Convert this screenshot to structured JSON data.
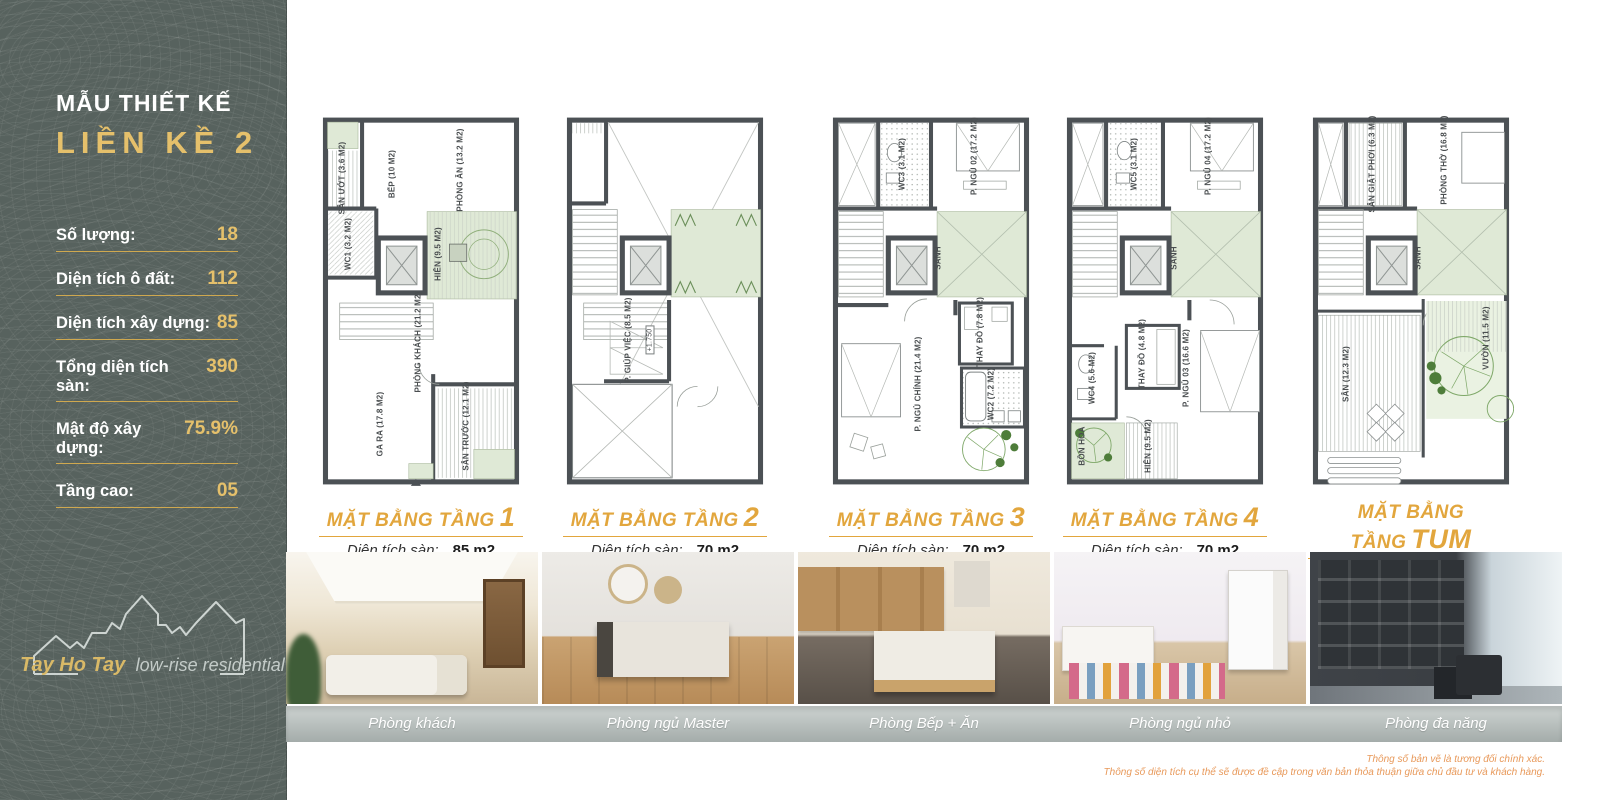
{
  "sidebar": {
    "title_line1": "MẪU THIẾT KẾ",
    "title_line2": "LIỀN KỀ 2",
    "stats": [
      {
        "label": "Số lượng:",
        "value": "18"
      },
      {
        "label": "Diện tích ô đất:",
        "value": "112"
      },
      {
        "label": "Diện tích xây dựng:",
        "value": "85"
      },
      {
        "label": "Tổng diện tích sàn:",
        "value": "390"
      },
      {
        "label": "Mật độ xây dựng:",
        "value": "75.9%"
      },
      {
        "label": "Tầng cao:",
        "value": "05"
      }
    ],
    "logo": {
      "brand": "Tay Ho Tay",
      "tagline": "low-rise residential"
    }
  },
  "plans": [
    {
      "title": "MẶT BẰNG TẦNG",
      "number": "1",
      "area_label": "Diện tích sàn:",
      "area_value": "85 m2",
      "rooms": [
        "SÂN ƯỚT (3.6 M2)",
        "BẾP (10 M2)",
        "PHÒNG ĂN (13.2 M2)",
        "WC1 (3.2 M2)",
        "HIÊN (9.5 M2)",
        "PHÒNG KHÁCH (21.2 M2)",
        "GA RA (17.8 M2)",
        "SÂN TRƯỚC (12.1 M2)"
      ]
    },
    {
      "title": "MẶT BẰNG TẦNG",
      "number": "2",
      "area_label": "Diện tích sàn:",
      "area_value": "70 m2",
      "rooms": [
        "P. GIÚP VIỆC (8.5 M2)",
        "+1.750"
      ]
    },
    {
      "title": "MẶT BẰNG TẦNG",
      "number": "3",
      "area_label": "Diện tích sàn:",
      "area_value": "70 m2",
      "rooms": [
        "WC3 (3.1 M2)",
        "P. NGỦ 02 (17.2 M2)",
        "SẢNH",
        "THAY ĐỒ (7.8 M2)",
        "P. NGỦ CHÍNH (21.4 M2)",
        "WC2 (7.2 M2)"
      ]
    },
    {
      "title": "MẶT BẰNG TẦNG",
      "number": "4",
      "area_label": "Diện tích sàn:",
      "area_value": "70 m2",
      "rooms": [
        "WC5 (3.1 M2)",
        "P. NGỦ 04 (17.2 M2)",
        "SẢNH",
        "THAY ĐỒ (4.8 M2)",
        "WC4 (5.6 M2)",
        "P. NGỦ 03 (16.6 M2)",
        "BỒN HOA",
        "HIÊN (9.5 M2)"
      ]
    },
    {
      "title": "MẶT BẰNG TẦNG",
      "number": "TUM",
      "area_label": "Diện tích sàn:",
      "area_value": "38 m2",
      "rooms": [
        "SÂN GIẶT PHƠI (6.3 M2)",
        "PHÒNG THỜ (16.8 M2)",
        "SẢNH",
        "VƯỜN (11.5 M2)",
        "SÂN (12.3 M2)"
      ]
    }
  ],
  "photos": [
    {
      "caption": "Phòng khách"
    },
    {
      "caption": "Phòng ngủ Master"
    },
    {
      "caption": "Phòng Bếp + Ăn"
    },
    {
      "caption": "Phòng ngủ nhỏ"
    },
    {
      "caption": "Phòng đa năng"
    }
  ],
  "disclaimer": [
    "Thông số bản vẽ là tương đối chính xác.",
    "Thông số diện tích cụ thể sẽ được đề cập trong văn bản thỏa thuận giữa chủ đầu tư và khách hàng."
  ],
  "colors": {
    "sidebar_bg": "#57625e",
    "accent_gold": "#e5c06b",
    "plan_title_orange": "#e2a63d",
    "caption_bar": "#aab2b0",
    "disclaimer_orange": "#e8995a",
    "plan_wall": "#4c5155",
    "plan_green": "#dfe9d6"
  }
}
